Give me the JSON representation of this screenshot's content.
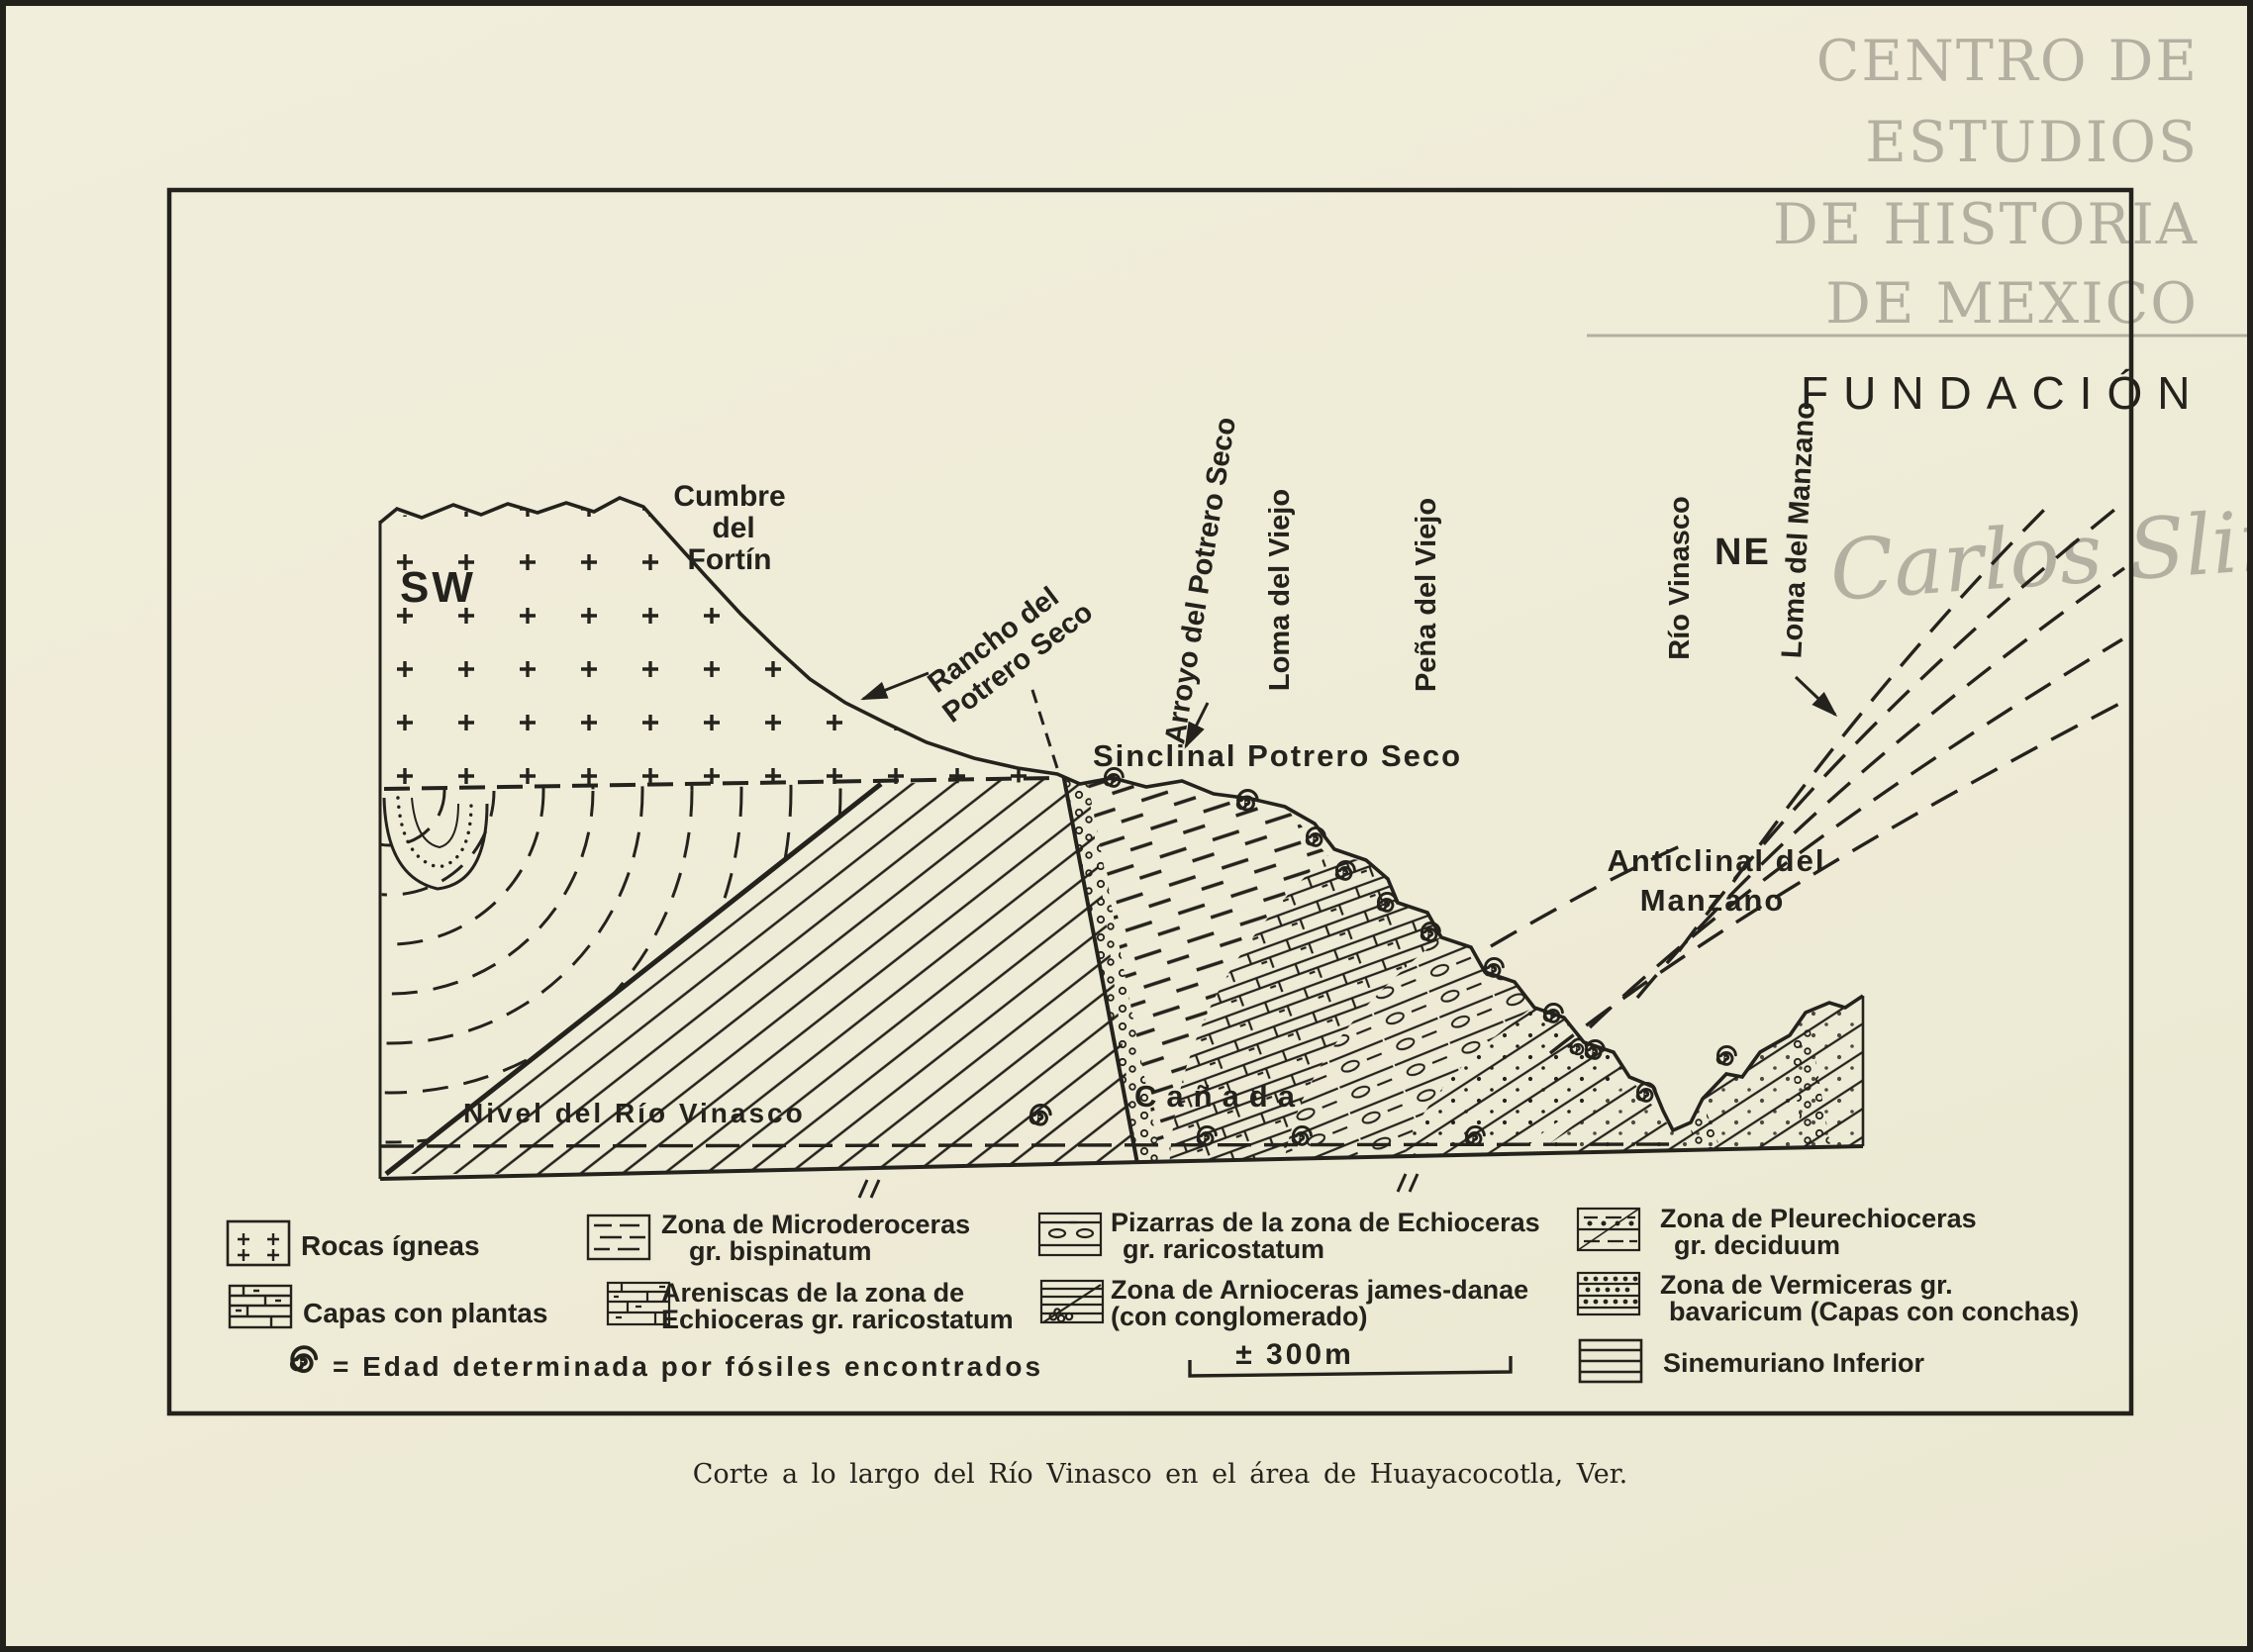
{
  "colors": {
    "paper": "#f0edd9",
    "ink": "#24221c",
    "watermark": "#b3b0a1"
  },
  "watermark": {
    "line1": "CENTRO DE",
    "line2": "ESTUDIOS",
    "line3": "DE HISTORIA",
    "line4": "DE MEXICO",
    "foundation": "FUNDACIÓN",
    "signature": "Carlos Slim"
  },
  "section": {
    "sw": "SW",
    "ne": "NE",
    "cumbre1": "Cumbre",
    "cumbre2": "del",
    "cumbre3": "Fortín",
    "rancho1": "Rancho del",
    "rancho2": "Potrero Seco",
    "arroyo": "Arroyo del Potrero Seco",
    "loma_viejo": "Loma del Viejo",
    "pena_viejo": "Peña del Viejo",
    "sinclinal": "Sinclinal Potrero Seco",
    "rio": "Río Vinasco",
    "loma_manzano": "Loma del Manzano",
    "anticlinal1": "Anticlinal del",
    "anticlinal2": "Manzano",
    "nivel": "Nivel del Río Vinasco",
    "canada": "Cañada"
  },
  "legend": {
    "rocas": "Rocas ígneas",
    "plantas": "Capas con plantas",
    "micro1": "Zona de  Microderoceras",
    "micro2": "gr. bispinatum",
    "aren1": "Areniscas de la zona de",
    "aren2": "Echioceras gr. raricostatum",
    "piza1": "Pizarras de la zona de Echioceras",
    "piza2": "gr. raricostatum",
    "arnio1": "Zona de Arnioceras james-danae",
    "arnio2": "(con conglomerado)",
    "pleure1": "Zona de  Pleurechioceras",
    "pleure2": "gr. deciduum",
    "vermi1": "Zona de  Vermiceras gr.",
    "vermi2": "bavaricum (Capas con conchas)",
    "sinem": "Sinemuriano Inferior",
    "fossil_note": "= Edad determinada por fósiles encontrados",
    "scale": "± 300m"
  },
  "caption": "Corte a lo largo del Río Vinasco en el área de Huayacocotla, Ver."
}
